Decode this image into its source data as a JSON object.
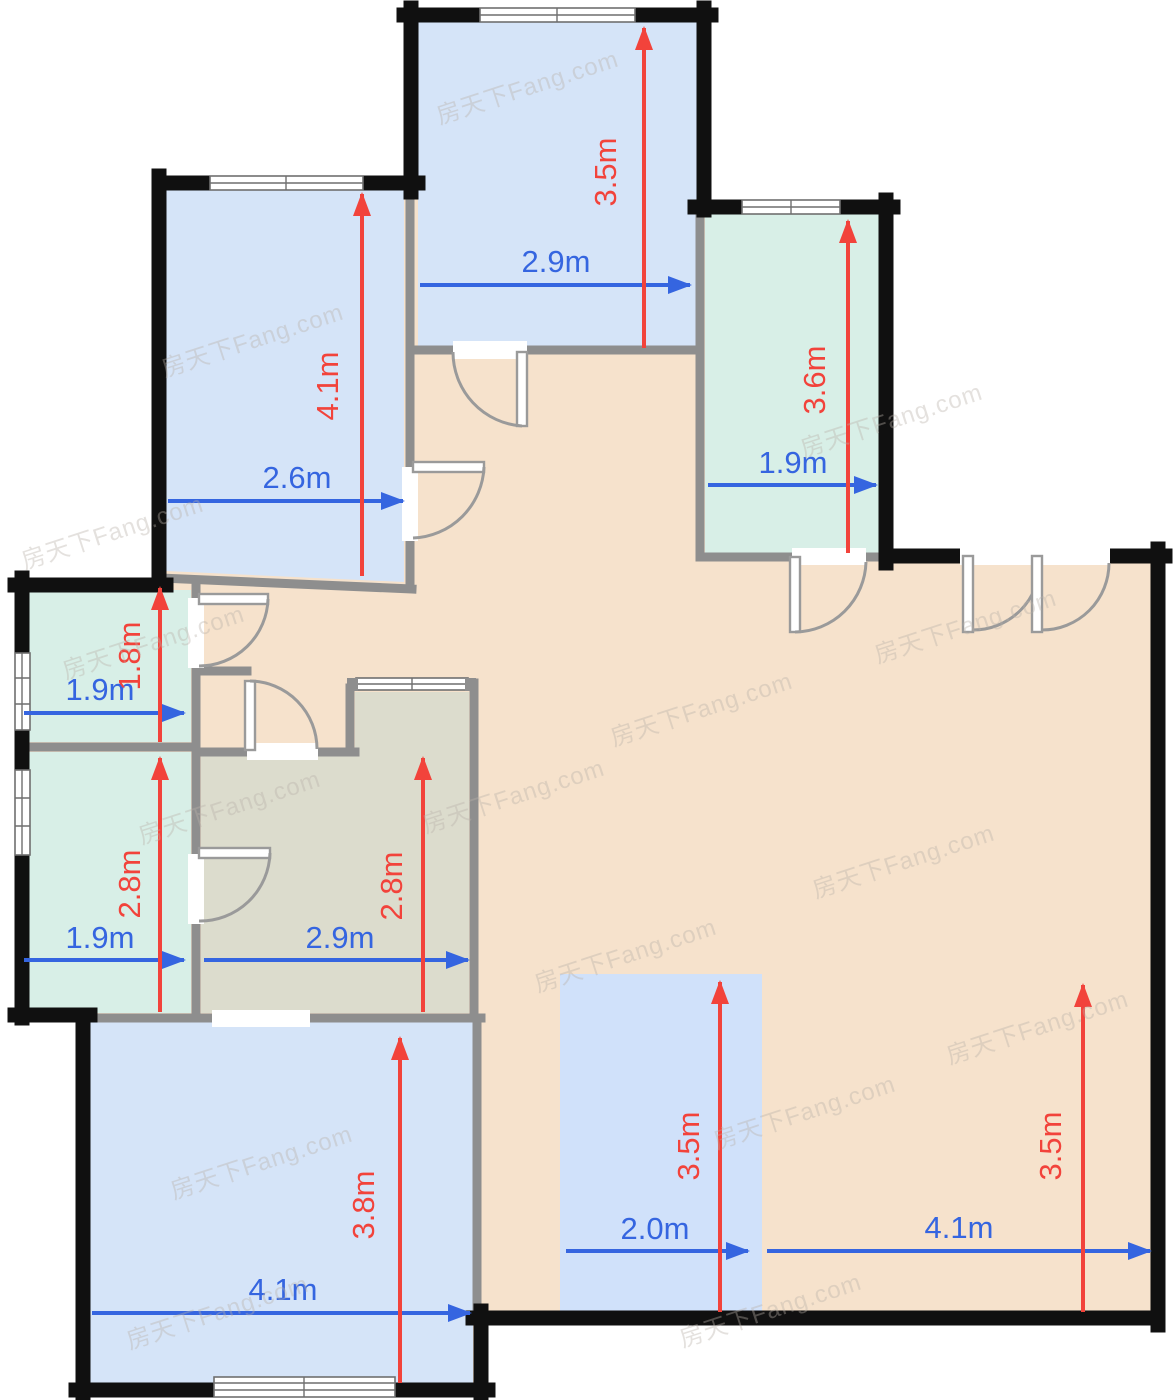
{
  "watermark": {
    "text": "房天下Fang.com",
    "color": "#b9b1a9"
  },
  "colors": {
    "exterior_wall": "#101010",
    "interior_wall": "#8e8e8e",
    "hall_fill": "#f6e2cc",
    "blue_room_fill": "#d5e4f8",
    "teal_room_fill": "#d8efe7",
    "kitchen_fill": "#dcdccd",
    "dining_strip_fill": "#d0e1fa",
    "width_dimension_color": "#3565e0",
    "depth_dimension_color": "#f2433b"
  },
  "rooms": [
    {
      "name": "bedroom-top-left",
      "width": "2.6m",
      "depth": "4.1m",
      "fill": "#d5e4f8"
    },
    {
      "name": "bedroom-top-center",
      "width": "2.9m",
      "depth": "3.5m",
      "fill": "#d5e4f8"
    },
    {
      "name": "room-top-right",
      "width": "1.9m",
      "depth": "3.6m",
      "fill": "#d8efe7"
    },
    {
      "name": "room-mid-left-small",
      "width": "1.9m",
      "depth": "1.8m",
      "fill": "#d8efe7"
    },
    {
      "name": "room-mid-left-large",
      "width": "1.9m",
      "depth": "2.8m",
      "fill": "#d8efe7"
    },
    {
      "name": "kitchen",
      "width": "2.9m",
      "depth": "2.8m",
      "fill": "#dcdccd"
    },
    {
      "name": "bedroom-bottom-left",
      "width": "4.1m",
      "depth": "3.8m",
      "fill": "#d5e4f8"
    },
    {
      "name": "dining-strip",
      "width": "2.0m",
      "depth": "3.5m",
      "fill": "#d0e1fa"
    },
    {
      "name": "living-hall",
      "width": "4.1m",
      "depth": "3.5m",
      "fill": "#f6e2cc"
    }
  ]
}
